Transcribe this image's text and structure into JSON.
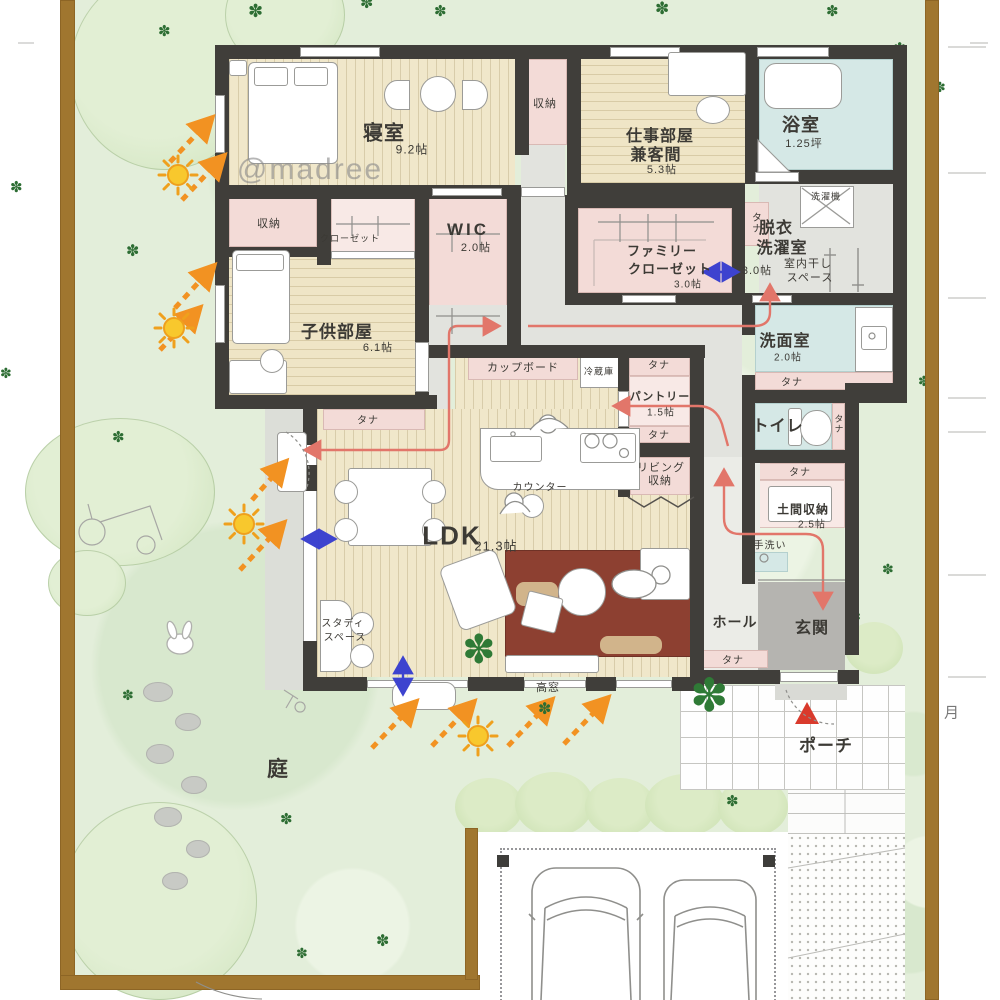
{
  "watermark": "@madree",
  "margin_glyph": "月",
  "rooms": {
    "bedroom": {
      "name": "寝室",
      "size": "9.2帖"
    },
    "work": {
      "name1": "仕事部屋",
      "name2": "兼客間",
      "size": "5.3帖"
    },
    "bath": {
      "name": "浴室",
      "size": "1.25坪"
    },
    "datsui": {
      "name1": "脱衣",
      "name2": "洗濯室",
      "size": "3.0帖",
      "note1": "室内干し",
      "note2": "スペース"
    },
    "wic": {
      "name": "WIC",
      "size": "2.0帖"
    },
    "family_closet": {
      "name1": "ファミリー",
      "name2": "クローゼット",
      "size": "3.0帖"
    },
    "kids": {
      "name": "子供部屋",
      "size": "6.1帖"
    },
    "senmen": {
      "name": "洗面室",
      "size": "2.0帖"
    },
    "toilet": {
      "name": "トイレ"
    },
    "pantry": {
      "name": "パントリー",
      "size": "1.5帖"
    },
    "doma": {
      "name": "土間収納",
      "size": "2.5帖"
    },
    "ldk": {
      "name": "LDK",
      "size": "21.3帖"
    },
    "hall": {
      "name": "ホール"
    },
    "genkan": {
      "name": "玄関"
    },
    "porch": {
      "name": "ポーチ"
    },
    "garden": {
      "name": "庭"
    }
  },
  "fixtures": {
    "washer": "洗濯機",
    "fridge": "冷蔵庫",
    "cupboard": "カップボード",
    "counter": "カウンター",
    "tearai": "手洗い",
    "shelf": "タナ",
    "storage": "収納",
    "closet": "クローゼット",
    "takamado": "高窓",
    "study1": "スタディ",
    "study2": "スペース",
    "living_storage1": "リビング",
    "living_storage2": "収納"
  },
  "icons": {
    "clover": "✽"
  }
}
